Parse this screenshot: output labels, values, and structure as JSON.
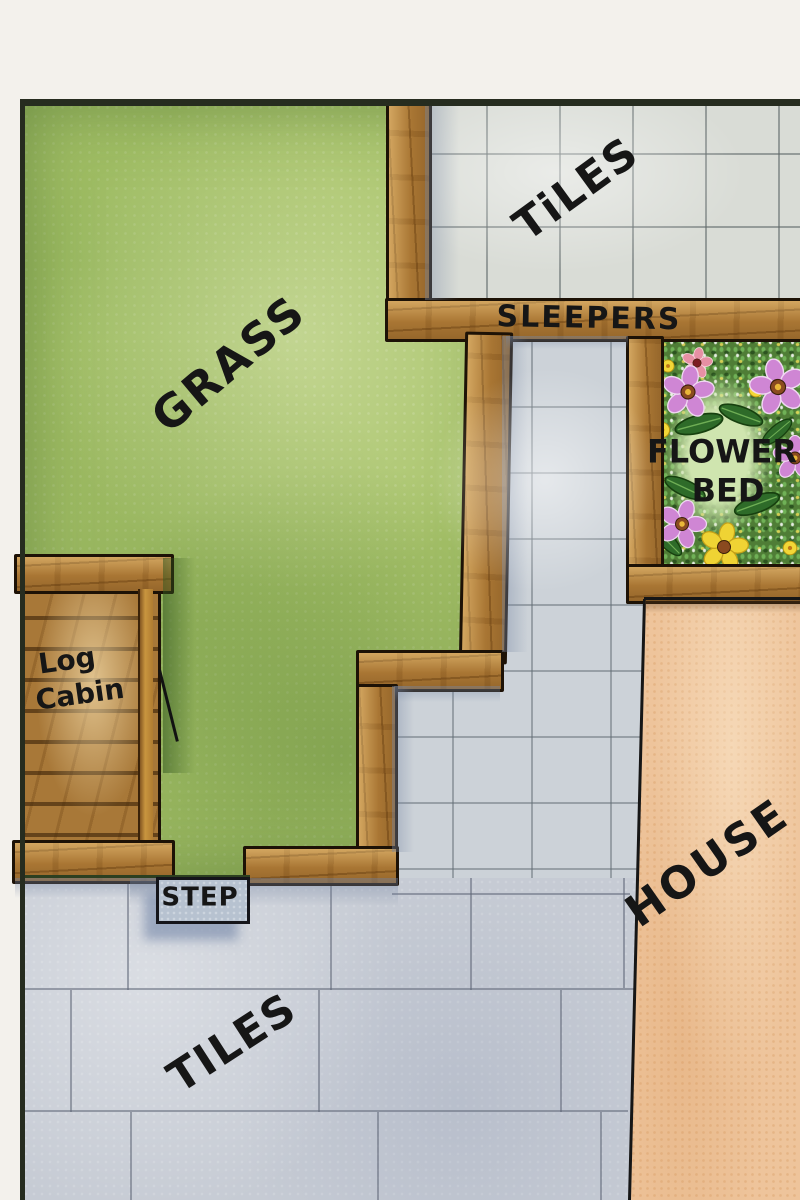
{
  "type": "hand-painted garden landscape plan",
  "labels": {
    "grass": "GRASS",
    "tiles_top": "TiLES",
    "sleepers": "SLEEPERS",
    "flower_line1": "FLOWER",
    "flower_line2": "BED",
    "log_line1": "Log",
    "log_line2": "Cabin",
    "step": "STEP",
    "tiles_bottom": "TILES",
    "house": "HOUSE"
  },
  "colors": {
    "paper": "#f3f1ec",
    "ink": "#161616",
    "grass": "#a9c46b",
    "wood": "#b5823c",
    "tiles_top": "#d9dcd6",
    "tiles_path": "#ccd2d8",
    "tiles_bottom": "#c6cbd4",
    "house": "#eec49b",
    "bed_green": "#4f7d36",
    "bed_light": "#cfe5af",
    "step_fill": "#b7c2d0"
  },
  "flowers": [
    {
      "type": "leaf",
      "x": 44,
      "y": 88,
      "size": 58,
      "rot": -15
    },
    {
      "type": "leaf",
      "x": 86,
      "y": 79,
      "size": 54,
      "rot": 20
    },
    {
      "type": "leaf",
      "x": 30,
      "y": 152,
      "size": 52,
      "rot": 25
    },
    {
      "type": "leaf",
      "x": 102,
      "y": 168,
      "size": 56,
      "rot": -20
    },
    {
      "type": "leaf",
      "x": 12,
      "y": 205,
      "size": 46,
      "rot": 45
    },
    {
      "type": "leaf",
      "x": 122,
      "y": 96,
      "size": 44,
      "rot": -40
    },
    {
      "type": "yellow-dot",
      "x": 7,
      "y": 94,
      "size": 20,
      "rot": 0
    },
    {
      "type": "yellow-dot",
      "x": 101,
      "y": 54,
      "size": 18,
      "rot": 0
    },
    {
      "type": "yellow-dot",
      "x": 13,
      "y": 30,
      "size": 16,
      "rot": 0
    },
    {
      "type": "yellow-dot",
      "x": 135,
      "y": 212,
      "size": 18,
      "rot": 0
    },
    {
      "type": "pink-red",
      "x": 42,
      "y": 27,
      "size": 32,
      "rot": 10
    },
    {
      "type": "purple",
      "x": 33,
      "y": 56,
      "size": 54,
      "rot": 8
    },
    {
      "type": "purple",
      "x": 123,
      "y": 51,
      "size": 58,
      "rot": -12
    },
    {
      "type": "purple",
      "x": 27,
      "y": 188,
      "size": 50,
      "rot": 18
    },
    {
      "type": "purple",
      "x": 140,
      "y": 122,
      "size": 46,
      "rot": 0
    },
    {
      "type": "yellow-daisy",
      "x": 69,
      "y": 211,
      "size": 50,
      "rot": 12
    }
  ]
}
